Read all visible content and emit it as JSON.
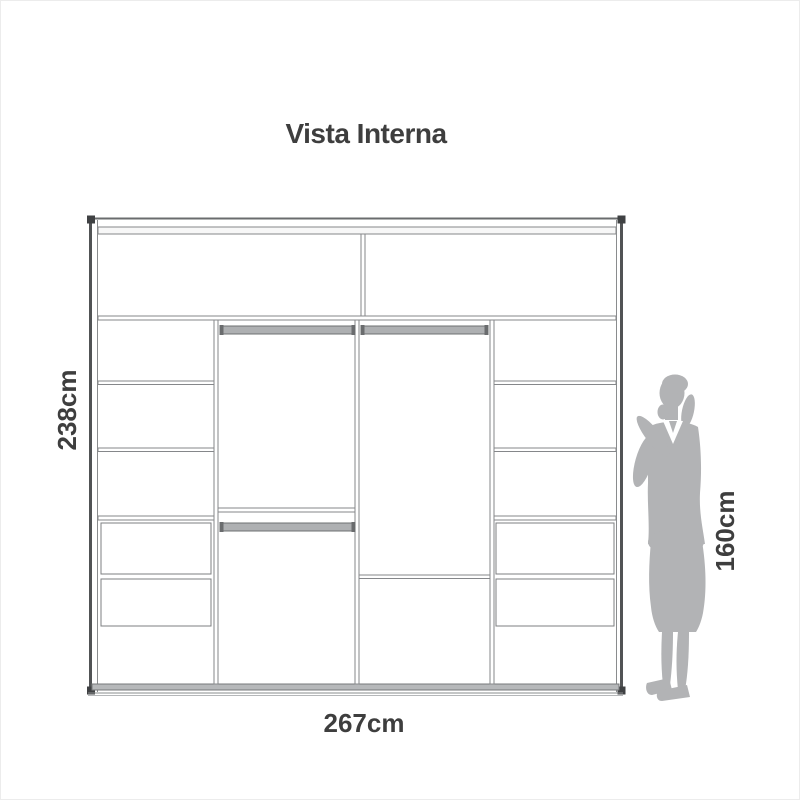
{
  "page": {
    "background": "#ffffff",
    "border_color": "#ececec"
  },
  "diagram": {
    "title": "Vista Interna",
    "labels": {
      "height": "238cm",
      "width": "267cm",
      "person_height": "160cm"
    },
    "colors": {
      "text": "#3e3e3e",
      "thin_line": "#85878a",
      "frame_edge": "#515355",
      "frame_cap": "#3f4143",
      "rod_fill": "#aeb0b2",
      "rod_edge": "#6e7072",
      "rod_cap": "#6a6c6e",
      "bottom_rail_fill": "#b6b8ba",
      "person_silhouette": "#b2b3b5"
    },
    "content": {
      "type": "wardrobe-internal-view",
      "top_cabinets": 2,
      "columns": 4,
      "hanging_rods": 3,
      "drawers": 4
    }
  }
}
